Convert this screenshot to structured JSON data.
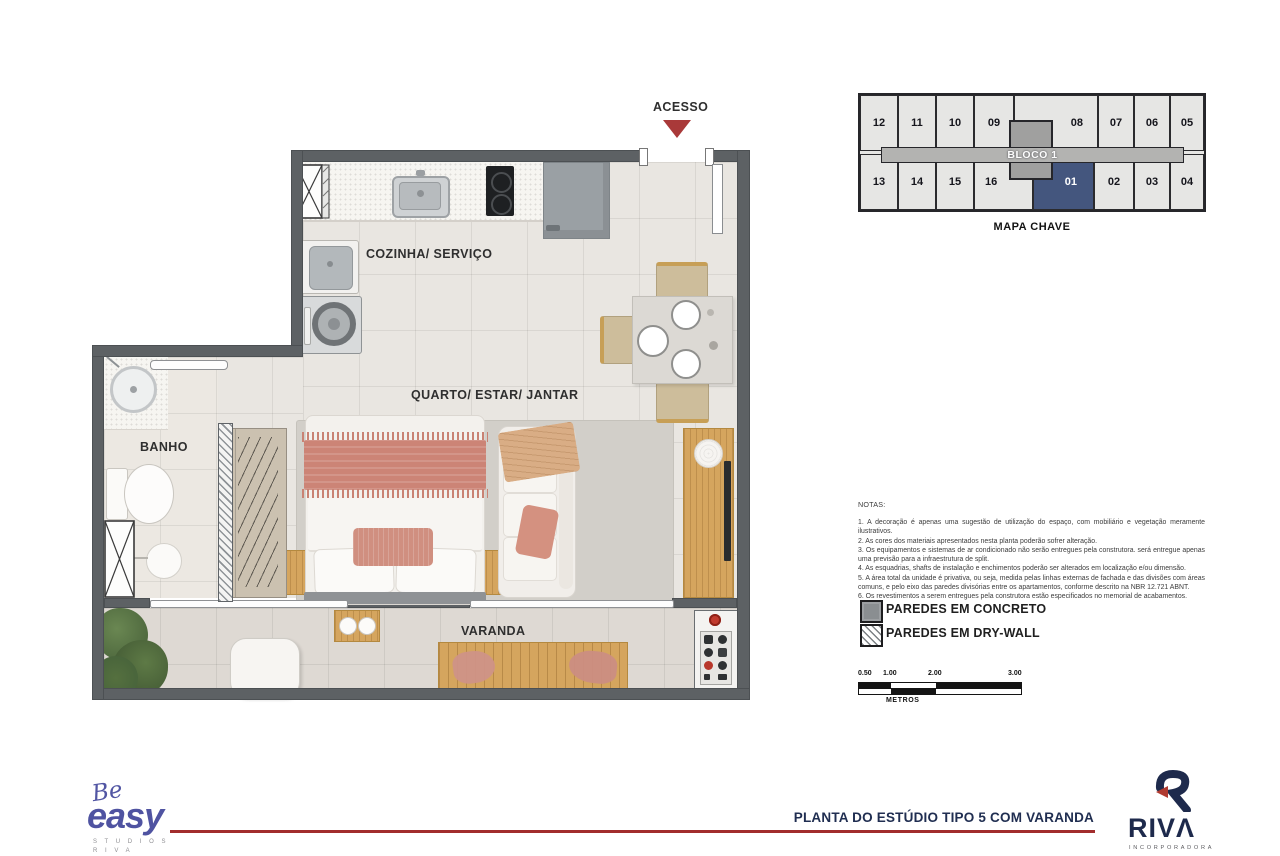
{
  "plan": {
    "access_label": "ACESSO",
    "rooms": {
      "kitchen": "COZINHA/ SERVIÇO",
      "main": "QUARTO/ ESTAR/ JANTAR",
      "bath": "BANHO",
      "balcony": "VARANDA"
    }
  },
  "key_map": {
    "title": "MAPA CHAVE",
    "block_label": "BLOCO 1",
    "top_row": [
      "12",
      "11",
      "10",
      "09",
      "08",
      "07",
      "06",
      "05"
    ],
    "bottom_row": [
      "13",
      "14",
      "15",
      "16",
      "01",
      "02",
      "03",
      "04"
    ],
    "highlighted_unit": "01",
    "highlight_color": "#44567e"
  },
  "notes": {
    "title": "NOTAS:",
    "items": [
      "1. A decoração é apenas uma sugestão de utilização do espaço, com mobiliário e vegetação meramente ilustrativos.",
      "2. As cores dos materiais apresentados nesta planta poderão sofrer alteração.",
      "3. Os equipamentos e sistemas de ar condicionado não serão entregues pela construtora. será entregue apenas uma previsão para a infraestrutura de split.",
      "4. As esquadrias, shafts de instalação e enchimentos poderão ser alterados em localização e/ou dimensão.",
      "5. A área total da unidade é privativa, ou seja, medida pelas linhas externas de fachada e das divisões com áreas comuns, e pelo eixo das paredes divisórias entre os apartamentos, conforme descrito na NBR 12.721 ABNT.",
      "6. Os revestimentos a serem entregues pela construtora estão especificados no memorial de acabamentos."
    ]
  },
  "legend": {
    "concrete": "PAREDES EM CONCRETO",
    "drywall": "PAREDES EM DRY-WALL"
  },
  "scale_bar": {
    "labels": [
      "0.50",
      "1.00",
      "2.00",
      "3.00"
    ],
    "unit": "METROS"
  },
  "footer": {
    "brand_script": "Be",
    "brand_word": "easy",
    "brand_sub1": "S T U D I O S",
    "brand_sub2": "R I V A",
    "title": "PLANTA DO ESTÚDIO TIPO 5 COM VARANDA",
    "riva_wordmark": "RIVΛ",
    "riva_sub": "INCORPORADORA"
  },
  "colors": {
    "wall": "#5d6164",
    "highlight_blue": "#44567e",
    "access_red": "#a93939",
    "footer_line_red": "#a22d2d",
    "brand_purple": "#4f53a1",
    "brand_navy": "#1e2a4c",
    "wood": "#d5a55e",
    "blanket_salmon": "#cc8476"
  }
}
